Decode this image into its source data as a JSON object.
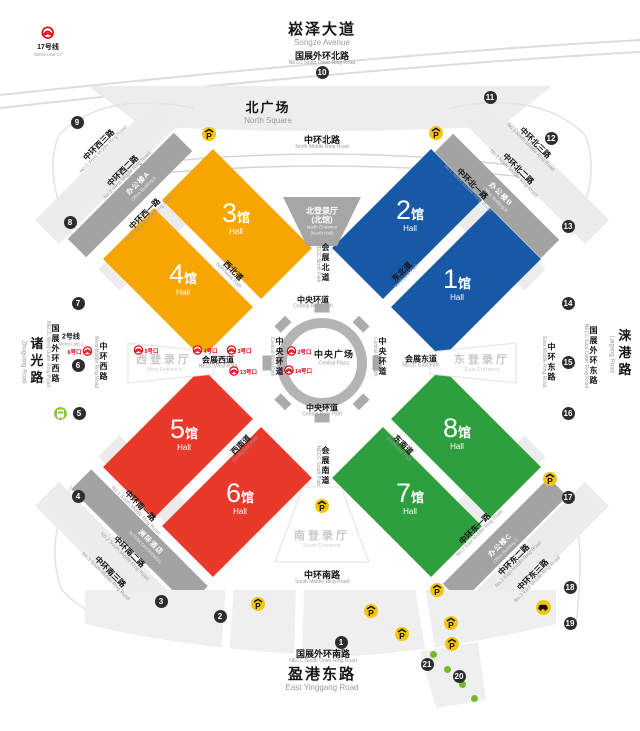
{
  "titles": {
    "songze": {
      "zh": "崧泽大道",
      "en": "Songze Avenue"
    },
    "outer_north": {
      "zh": "国展外环北路",
      "en": "NECC North Outer Ring Road"
    },
    "north_square": {
      "zh": "北广场",
      "en": "North Square"
    },
    "outer_south": {
      "zh": "国展外环南路",
      "en": "NECC South Outer Ring Road"
    },
    "yinggang": {
      "zh": "盈港东路",
      "en": "East Yinggang Road"
    }
  },
  "plaza": {
    "zh": "中央广场",
    "en": "Central Plaza"
  },
  "entrances": {
    "north": {
      "zh1": "北登录厅",
      "zh2": "(北馆)",
      "en1": "North Entrance",
      "en2": "(North Hall)"
    },
    "west": {
      "zh": "西登录厅",
      "en": "West Entrance"
    },
    "east": {
      "zh": "东登录厅",
      "en": "East Entrance"
    },
    "south": {
      "zh": "南登录厅",
      "en": "South Entrance"
    }
  },
  "hall_text": {
    "suffix": "馆",
    "sub": "Hall"
  },
  "halls": [
    {
      "num": "1",
      "color": "#1759A6",
      "cx": 466,
      "cy": 283,
      "rot": -45,
      "lx": 457,
      "ly": 284
    },
    {
      "num": "2",
      "color": "#1759A6",
      "cx": 407,
      "cy": 224,
      "rot": -45,
      "lx": 410,
      "ly": 215
    },
    {
      "num": "3",
      "color": "#F7A600",
      "cx": 237,
      "cy": 224,
      "rot": 45,
      "lx": 236,
      "ly": 218
    },
    {
      "num": "4",
      "color": "#F7A600",
      "cx": 178,
      "cy": 283,
      "rot": 45,
      "lx": 183,
      "ly": 279
    },
    {
      "num": "5",
      "color": "#E8392B",
      "cx": 178,
      "cy": 443,
      "rot": -45,
      "lx": 184,
      "ly": 434
    },
    {
      "num": "6",
      "color": "#E8392B",
      "cx": 237,
      "cy": 502,
      "rot": -45,
      "lx": 240,
      "ly": 498
    },
    {
      "num": "7",
      "color": "#2E9F3F",
      "cx": 407,
      "cy": 502,
      "rot": 45,
      "lx": 410,
      "ly": 498
    },
    {
      "num": "8",
      "color": "#2E9F3F",
      "cx": 466,
      "cy": 443,
      "rot": 45,
      "lx": 457,
      "ly": 433
    }
  ],
  "road_labels": [
    {
      "zh": "中环北路",
      "en": "North Middle Ring Road",
      "x": 322,
      "y": 143,
      "cls": "md"
    },
    {
      "zh": "中环西三路",
      "en": "No.3 West Middle Ring Road",
      "x": 101,
      "y": 147,
      "rot": -45,
      "cls": "sm"
    },
    {
      "zh": "中环西二路",
      "en": "No.2 West Middle Ring Road",
      "x": 125,
      "y": 173,
      "rot": -45,
      "cls": "sm"
    },
    {
      "zh": "中环西一路",
      "en": "No.1 West Middle Ring Road",
      "x": 147,
      "y": 216,
      "rot": -45,
      "cls": "sm"
    },
    {
      "zh": "中环北三路",
      "en": "No.3 North Middle Ring Road",
      "x": 533,
      "y": 145,
      "rot": 45,
      "cls": "sm"
    },
    {
      "zh": "中环北二路",
      "en": "No.2 North Middle Ring Road",
      "x": 516,
      "y": 171,
      "rot": 45,
      "cls": "sm"
    },
    {
      "zh": "中环北一路",
      "en": "No.1 North Middle Ring Road",
      "x": 470,
      "y": 186,
      "rot": 45,
      "cls": "sm"
    },
    {
      "zh": "西北道",
      "en": "Northwest Path",
      "x": 231,
      "y": 273,
      "rot": 45,
      "cls": "sm"
    },
    {
      "zh": "东北道",
      "en": "Northeast Path",
      "x": 404,
      "y": 274,
      "rot": -45,
      "cls": "sm"
    },
    {
      "zh": "西南道",
      "en": "Southwest Path",
      "x": 243,
      "y": 447,
      "rot": -45,
      "cls": "sm"
    },
    {
      "zh": "东南道",
      "en": "Southeast Path",
      "x": 401,
      "y": 447,
      "rot": 45,
      "cls": "sm"
    },
    {
      "zh": "会展北道",
      "en": "NECC North Path",
      "x": 322,
      "y": 263,
      "vert": true,
      "cls": "sm"
    },
    {
      "zh": "会展南道",
      "en": "NECC South Path",
      "x": 322,
      "y": 466,
      "vert": true,
      "cls": "sm"
    },
    {
      "zh": "会展西道",
      "en": "NECC West Path",
      "x": 218,
      "y": 363,
      "cls": "sm"
    },
    {
      "zh": "会展东道",
      "en": "NECC East Path",
      "x": 421,
      "y": 362,
      "cls": "sm"
    },
    {
      "zh": "中央环道",
      "en": "Central Ring Path",
      "x": 313,
      "y": 303,
      "cls": "sm"
    },
    {
      "zh": "中央环道",
      "en": "Central Ring Path",
      "x": 322,
      "y": 411,
      "cls": "sm"
    },
    {
      "zh": "中央环道",
      "en": "Central Ring Path",
      "x": 276,
      "y": 357,
      "vert": true,
      "cls": "sm"
    },
    {
      "zh": "中央环道",
      "en": "Central Ring Path",
      "x": 379,
      "y": 357,
      "vert": true,
      "cls": "sm"
    },
    {
      "zh": "中环西路",
      "en": "West Middle Ring Road",
      "x": 100,
      "y": 362,
      "vert": true,
      "cls": "sm"
    },
    {
      "zh": "中环东路",
      "en": "East Middle Ring Road",
      "x": 548,
      "y": 362,
      "vert": true,
      "cls": "sm"
    },
    {
      "zh": "国展外环西路",
      "en": "NECC West Outer Ring Road",
      "x": 52,
      "y": 354,
      "vert": true,
      "cls": "sm"
    },
    {
      "zh": "国展外环东路",
      "en": "NECC East Outer Ring Road",
      "x": 590,
      "y": 356,
      "vert": true,
      "cls": "sm"
    },
    {
      "zh": "诸光路",
      "en": "Zhuguang Road",
      "x": 31,
      "y": 362,
      "vert": true,
      "cls": "vlg"
    },
    {
      "zh": "涞港路",
      "en": "Laigang Road",
      "x": 619,
      "y": 354,
      "vert": true,
      "cls": "vlg"
    },
    {
      "zh": "中环南路",
      "en": "South Middle Ring Road",
      "x": 322,
      "y": 578,
      "cls": "md"
    },
    {
      "zh": "中环南一路",
      "en": "No.1 South Middle Ring Road",
      "x": 138,
      "y": 508,
      "rot": 45,
      "cls": "sm"
    },
    {
      "zh": "中环南二路",
      "en": "No.2 South Middle Ring Road",
      "x": 127,
      "y": 554,
      "rot": 45,
      "cls": "sm"
    },
    {
      "zh": "中环南三路",
      "en": "No.3 South Middle Ring Road",
      "x": 108,
      "y": 574,
      "rot": 45,
      "cls": "sm"
    },
    {
      "zh": "中环东一路",
      "en": "No.1 East Middle Ring Road",
      "x": 477,
      "y": 531,
      "rot": -45,
      "cls": "sm"
    },
    {
      "zh": "中环东二路",
      "en": "No.2 East Middle Ring Road",
      "x": 516,
      "y": 562,
      "rot": -45,
      "cls": "sm"
    },
    {
      "zh": "中环东三路",
      "en": "No.3 East Middle Ring Road",
      "x": 535,
      "y": 577,
      "rot": -45,
      "cls": "sm"
    }
  ],
  "buildings": [
    {
      "zh": "办公楼A",
      "en": "Office Building A",
      "x": 141,
      "y": 186,
      "rot": -45
    },
    {
      "zh": "办公楼B",
      "en": "Office Building B",
      "x": 498,
      "y": 197,
      "rot": 45
    },
    {
      "zh": "洲际酒店",
      "en": "INTERCONTINENTAL",
      "x": 148,
      "y": 545,
      "rot": 45
    },
    {
      "zh": "办公楼C",
      "en": "Office Building C",
      "x": 503,
      "y": 548,
      "rot": -45
    }
  ],
  "metro": {
    "lines": [
      {
        "zh": "17号线",
        "en": "Metro Line 17",
        "x": 48,
        "y": 42,
        "icon": true
      },
      {
        "zh": "2号线",
        "en": "Metro Line 2",
        "x": 71,
        "y": 340,
        "icon": false
      }
    ],
    "exits": [
      {
        "label": "6号口",
        "x": 80,
        "y": 352,
        "side": "left"
      },
      {
        "label": "5号口",
        "x": 146,
        "y": 351,
        "side": "right"
      },
      {
        "label": "4号口",
        "x": 205,
        "y": 351,
        "side": "right"
      },
      {
        "label": "3号口",
        "x": 239,
        "y": 351,
        "side": "right"
      },
      {
        "label": "13号口",
        "x": 243,
        "y": 372,
        "side": "right"
      },
      {
        "label": "2号口",
        "x": 299,
        "y": 352,
        "side": "right"
      },
      {
        "label": "14号口",
        "x": 298,
        "y": 371,
        "side": "right"
      }
    ]
  },
  "gates": [
    {
      "n": "1",
      "x": 341,
      "y": 642
    },
    {
      "n": "2",
      "x": 220,
      "y": 616
    },
    {
      "n": "3",
      "x": 161,
      "y": 601
    },
    {
      "n": "4",
      "x": 78,
      "y": 496
    },
    {
      "n": "5",
      "x": 79,
      "y": 413
    },
    {
      "n": "6",
      "x": 78,
      "y": 365
    },
    {
      "n": "7",
      "x": 78,
      "y": 303
    },
    {
      "n": "8",
      "x": 70,
      "y": 222
    },
    {
      "n": "9",
      "x": 77,
      "y": 122
    },
    {
      "n": "10",
      "x": 322,
      "y": 72
    },
    {
      "n": "11",
      "x": 490,
      "y": 97
    },
    {
      "n": "12",
      "x": 551,
      "y": 138
    },
    {
      "n": "13",
      "x": 568,
      "y": 226
    },
    {
      "n": "14",
      "x": 568,
      "y": 303
    },
    {
      "n": "15",
      "x": 568,
      "y": 362
    },
    {
      "n": "16",
      "x": 568,
      "y": 413
    },
    {
      "n": "17",
      "x": 568,
      "y": 497
    },
    {
      "n": "18",
      "x": 570,
      "y": 587
    },
    {
      "n": "19",
      "x": 570,
      "y": 623
    },
    {
      "n": "20",
      "x": 459,
      "y": 676
    },
    {
      "n": "21",
      "x": 427,
      "y": 664
    }
  ],
  "icons": {
    "parking_glyph": "P",
    "parking": [
      {
        "x": 209,
        "y": 134
      },
      {
        "x": 436,
        "y": 133
      },
      {
        "x": 322,
        "y": 506
      },
      {
        "x": 437,
        "y": 590
      },
      {
        "x": 258,
        "y": 604
      },
      {
        "x": 371,
        "y": 611
      },
      {
        "x": 402,
        "y": 634
      },
      {
        "x": 451,
        "y": 623
      },
      {
        "x": 452,
        "y": 644
      },
      {
        "x": 550,
        "y": 479
      }
    ],
    "taxi": {
      "x": 543,
      "y": 607
    },
    "bus": {
      "x": 60,
      "y": 413
    },
    "trees": [
      {
        "x": 433,
        "y": 654
      },
      {
        "x": 447,
        "y": 669
      },
      {
        "x": 462,
        "y": 684
      },
      {
        "x": 474,
        "y": 698
      }
    ]
  },
  "colors": {
    "hall_blue": "#1759A6",
    "hall_orange": "#F7A600",
    "hall_red": "#E8392B",
    "hall_green": "#2E9F3F",
    "parking_yellow": "#F6C50A",
    "metro_red": "#E60012",
    "gate_dark": "#2d2d2d",
    "bus_green": "#8CC63F",
    "tree_green": "#76B82A",
    "band_gray": "#A3A3A3",
    "area_light": "#EDEDED"
  }
}
